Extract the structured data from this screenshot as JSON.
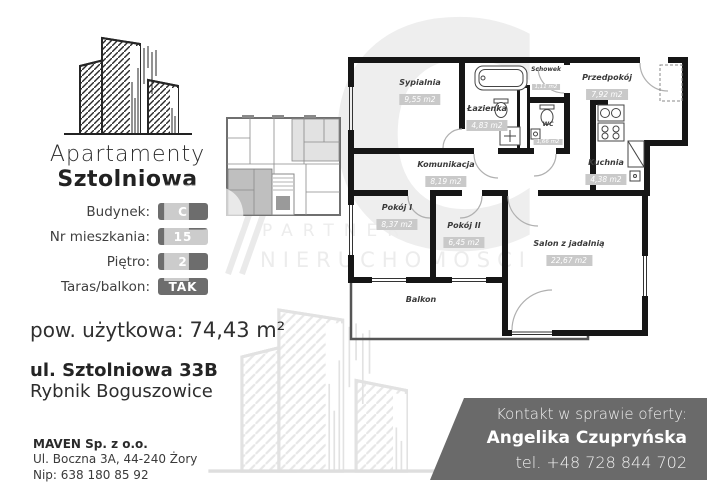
{
  "brand": {
    "name_line1": "Apartamenty",
    "name_line2": "Sztolniowa"
  },
  "details": {
    "rows": [
      {
        "label": "Budynek:",
        "value": "C"
      },
      {
        "label": "Nr mieszkania:",
        "value": "15"
      },
      {
        "label": "Piętro:",
        "value": "2"
      },
      {
        "label": "Taras/balkon:",
        "value": "TAK"
      }
    ]
  },
  "area": {
    "label": "pow. użytkowa:",
    "value": "74,43 m²"
  },
  "address": {
    "street": "ul. Sztolniowa 33B",
    "city": "Rybnik Boguszowice"
  },
  "company": {
    "name": "MAVEN Sp. z o.o.",
    "address_line": "Ul. Boczna 3A, 44-240 Żory",
    "nip_line": "Nip: 638 180 85 92"
  },
  "contact": {
    "heading": "Kontakt w sprawie oferty:",
    "agent": "Angelika Czupryńska",
    "phone": "tel. +48 728 844 702"
  },
  "watermark": {
    "word1": "PARTNER",
    "word2": "NIERUCHOMOŚCI",
    "big_letter": "C",
    "overlay_letter": "P"
  },
  "floor_plan": {
    "rooms": [
      {
        "name": "Sypialnia",
        "area": "9,55 m2"
      },
      {
        "name": "Łazienka",
        "area": "4,83 m2"
      },
      {
        "name": "Schowek",
        "area": "1,11 m2"
      },
      {
        "name": "WC",
        "area": "1,66 m2"
      },
      {
        "name": "Przedpokój",
        "area": "7,92 m2"
      },
      {
        "name": "Kuchnia",
        "area": "4,38 m2"
      },
      {
        "name": "Komunikacja",
        "area": "8,19 m2"
      },
      {
        "name": "Pokój I",
        "area": "8,37 m2"
      },
      {
        "name": "Pokój II",
        "area": "6,45 m2"
      },
      {
        "name": "Salon z jadalnią",
        "area": "22,67 m2"
      },
      {
        "name": "Balkon",
        "area": ""
      }
    ]
  },
  "colors": {
    "accent_gray": "#6d6d6d",
    "banner_gray": "#6a6a6a",
    "wall_black": "#161616",
    "area_badge_gray": "#c9c9c9",
    "highlight_unit_gray": "#bfbfbf",
    "watermark_gray": "#ececec"
  }
}
